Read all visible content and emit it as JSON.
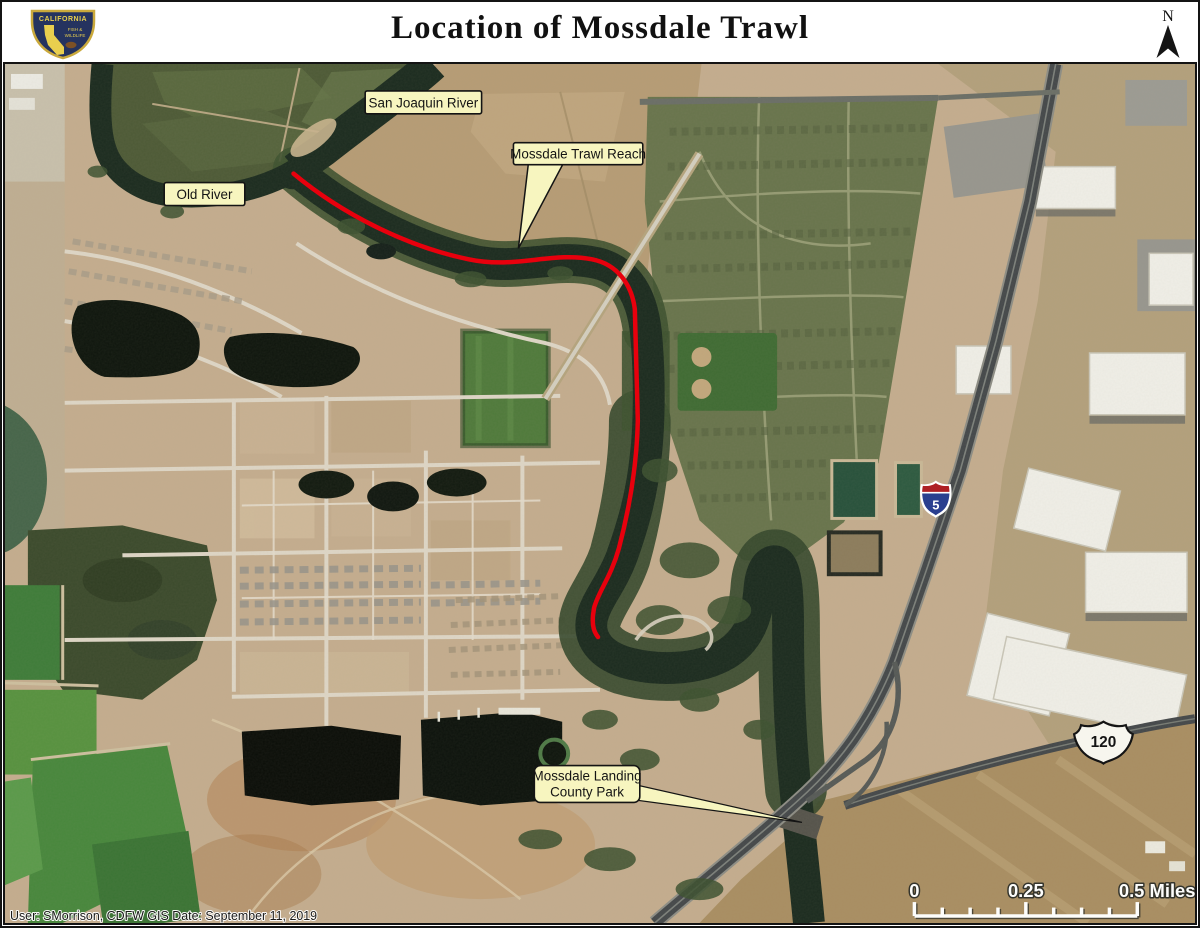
{
  "page": {
    "title": "Location of Mossdale Trawl",
    "footer_credit": "User: SMorrison, CDFW GIS   Date:  September 11, 2019"
  },
  "logo": {
    "state": "CALIFORNIA",
    "dept_line1": "FISH &",
    "dept_line2": "WILDLIFE"
  },
  "north_arrow": {
    "label": "N"
  },
  "map_labels": {
    "san_joaquin_river": "San Joaquin River",
    "old_river": "Old River",
    "mossdale_trawl_reach": "Mossdale Trawl Reach",
    "county_park_line1": "Mossdale Landing",
    "county_park_line2": "County Park"
  },
  "route_shields": {
    "interstate_5": "5",
    "route_120": "120"
  },
  "scale_bar": {
    "start": "0",
    "middle": "0.25",
    "end": "0.5 Miles"
  },
  "legend_colors": {
    "trawl_reach_line": "#e8000d",
    "label_fill": "#f7f5bf",
    "water": "#1b2b1f"
  }
}
